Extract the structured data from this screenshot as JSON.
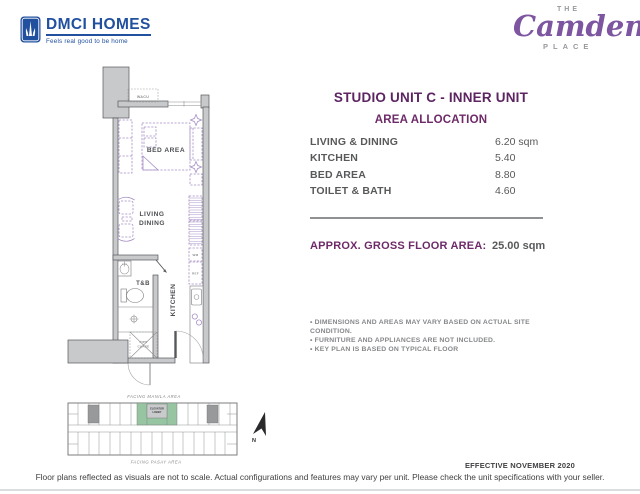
{
  "colors": {
    "brand_blue": "#21509f",
    "title_purple": "#5c2562",
    "accent_purple": "#6e2a68",
    "camden_purple": "#7d55a0",
    "text_gray": "#58595b",
    "note_gray": "#85878a",
    "wall_fill": "#c8c9cb",
    "wall_stroke": "#55575a",
    "furniture_purple": "#a78fc6",
    "keyplan_green": "#97c4a1"
  },
  "header": {
    "dmci_name": "DMCI HOMES",
    "dmci_tagline": "Feels real good to be home",
    "camden_the": "THE",
    "camden_name": "Camden",
    "camden_place": "PLACE"
  },
  "unit": {
    "title": "STUDIO UNIT C - INNER UNIT",
    "subtitle": "AREA ALLOCATION",
    "areas": [
      {
        "label": "LIVING & DINING",
        "value": "6.20 sqm"
      },
      {
        "label": "KITCHEN",
        "value": "5.40"
      },
      {
        "label": "BED AREA",
        "value": "8.80"
      },
      {
        "label": "TOILET & BATH",
        "value": "4.60"
      }
    ],
    "gross_label": "APPROX. GROSS FLOOR AREA:",
    "gross_value": "25.00 sqm",
    "notes": [
      "• DIMENSIONS AND AREAS MAY VARY BASED ON ACTUAL SITE CONDITION.",
      "• FURNITURE AND APPLIANCES ARE NOT INCLUDED.",
      "• KEY PLAN IS BASED ON TYPICAL FLOOR"
    ]
  },
  "floor_plan": {
    "wacu": "WACU",
    "bed_area": "BED AREA",
    "living": "LIVING",
    "dining": "DINING",
    "tb": "T&B",
    "kitchen": "KITCHEN",
    "wm": "WM",
    "ref": "REF",
    "pipe": "PIPE",
    "chase": "CHASE"
  },
  "key_plan": {
    "facing_top": "FACING MANILA AREA",
    "facing_bottom": "FACING PASAY AREA",
    "lobby_line1": "ELEVATOR",
    "lobby_line2": "LOBBY",
    "north": "N"
  },
  "footer": {
    "effective": "EFFECTIVE NOVEMBER 2020",
    "disclaimer": "Floor plans reflected as visuals are not to scale. Actual configurations and features may vary per unit. Please check the unit specifications with your seller."
  }
}
